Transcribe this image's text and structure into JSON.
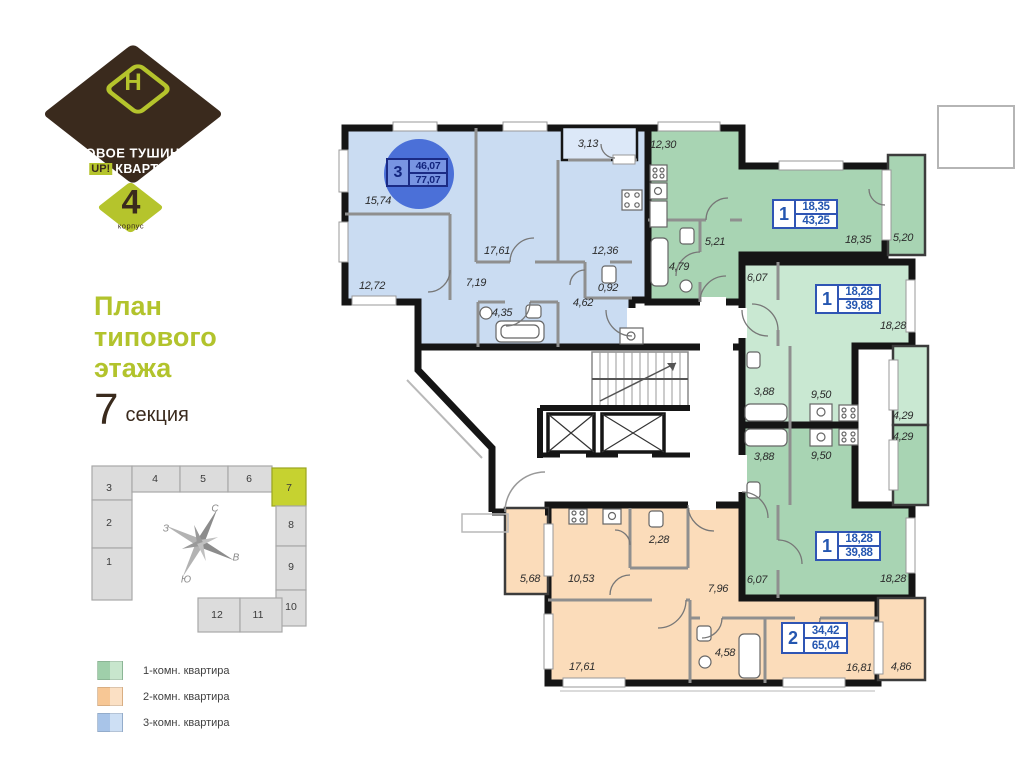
{
  "branding": {
    "name_line1": "НОВОЕ ТУШИНО",
    "up_label": "UP!",
    "name_line2": "КВАРТАЛ",
    "logo_letter": "Н",
    "building_number": "4",
    "building_label": "корпус"
  },
  "title": {
    "line1": "План",
    "line2": "типового",
    "line3": "этажа",
    "section_number": "7",
    "section_label": "секция"
  },
  "minimap": {
    "highlighted": "7",
    "sections": [
      {
        "number": "1"
      },
      {
        "number": "2"
      },
      {
        "number": "3"
      },
      {
        "number": "4"
      },
      {
        "number": "5"
      },
      {
        "number": "6"
      },
      {
        "number": "7"
      },
      {
        "number": "8"
      },
      {
        "number": "9"
      },
      {
        "number": "10"
      },
      {
        "number": "11"
      },
      {
        "number": "12"
      }
    ],
    "compass": {
      "north": "С",
      "east": "В",
      "south": "Ю",
      "west": "З"
    }
  },
  "legend": {
    "items": [
      {
        "label": "1-комн. квартира",
        "color": "#9fcfaa",
        "color_light": "#c8e6cd"
      },
      {
        "label": "2-комн. квартира",
        "color": "#f7c795",
        "color_light": "#fbe0c4"
      },
      {
        "label": "3-комн. квартира",
        "color": "#a8c4e8",
        "color_light": "#cddff4"
      }
    ]
  },
  "colors": {
    "brand_brown": "#3a2a1d",
    "accent_lime": "#b5c42c",
    "apt_1room": "#a8d4b3",
    "apt_1room_light": "#c9e8d2",
    "apt_2room": "#fbdcba",
    "apt_3room": "#cadcf2",
    "badge_blue": "#2456b0",
    "circle_blue": "#4b70d8"
  },
  "plan": {
    "apartments": [
      {
        "type": "3-room",
        "badge": {
          "rooms": "3",
          "living": "46,07",
          "total": "77,07"
        },
        "areas": {
          "room_a": "15,74",
          "room_b": "12,72",
          "room_c": "17,61",
          "hall": "7,19",
          "bath": "4,35",
          "kitchen": "12,36",
          "balcony": "3,13",
          "wc": "0,92",
          "entry": "4,62"
        }
      },
      {
        "type": "1-room",
        "badge": {
          "rooms": "1",
          "living": "18,35",
          "total": "43,25"
        },
        "areas": {
          "kitchen": "12,30",
          "bath": "4,79",
          "hall": "5,21",
          "room": "18,35",
          "balcony": "5,20"
        }
      },
      {
        "type": "1-room",
        "badge": {
          "rooms": "1",
          "living": "18,28",
          "total": "39,88"
        },
        "areas": {
          "hall": "6,07",
          "room": "18,28",
          "kitchen": "9,50",
          "bath": "3,88",
          "balcony": "4,29"
        }
      },
      {
        "type": "1-room",
        "badge": {
          "rooms": "1",
          "living": "18,28",
          "total": "39,88"
        },
        "areas": {
          "bath": "3,88",
          "kitchen": "9,50",
          "balcony": "4,29",
          "room": "18,28",
          "hall": "6,07"
        }
      },
      {
        "type": "2-room",
        "badge": {
          "rooms": "2",
          "living": "34,42",
          "total": "65,04"
        },
        "areas": {
          "balcony_a": "5,68",
          "kitchen": "10,53",
          "wc": "2,28",
          "hall": "7,96",
          "room_a": "17,61",
          "bath": "4,58",
          "room_b": "16,81",
          "balcony_b": "4,86"
        }
      }
    ]
  }
}
